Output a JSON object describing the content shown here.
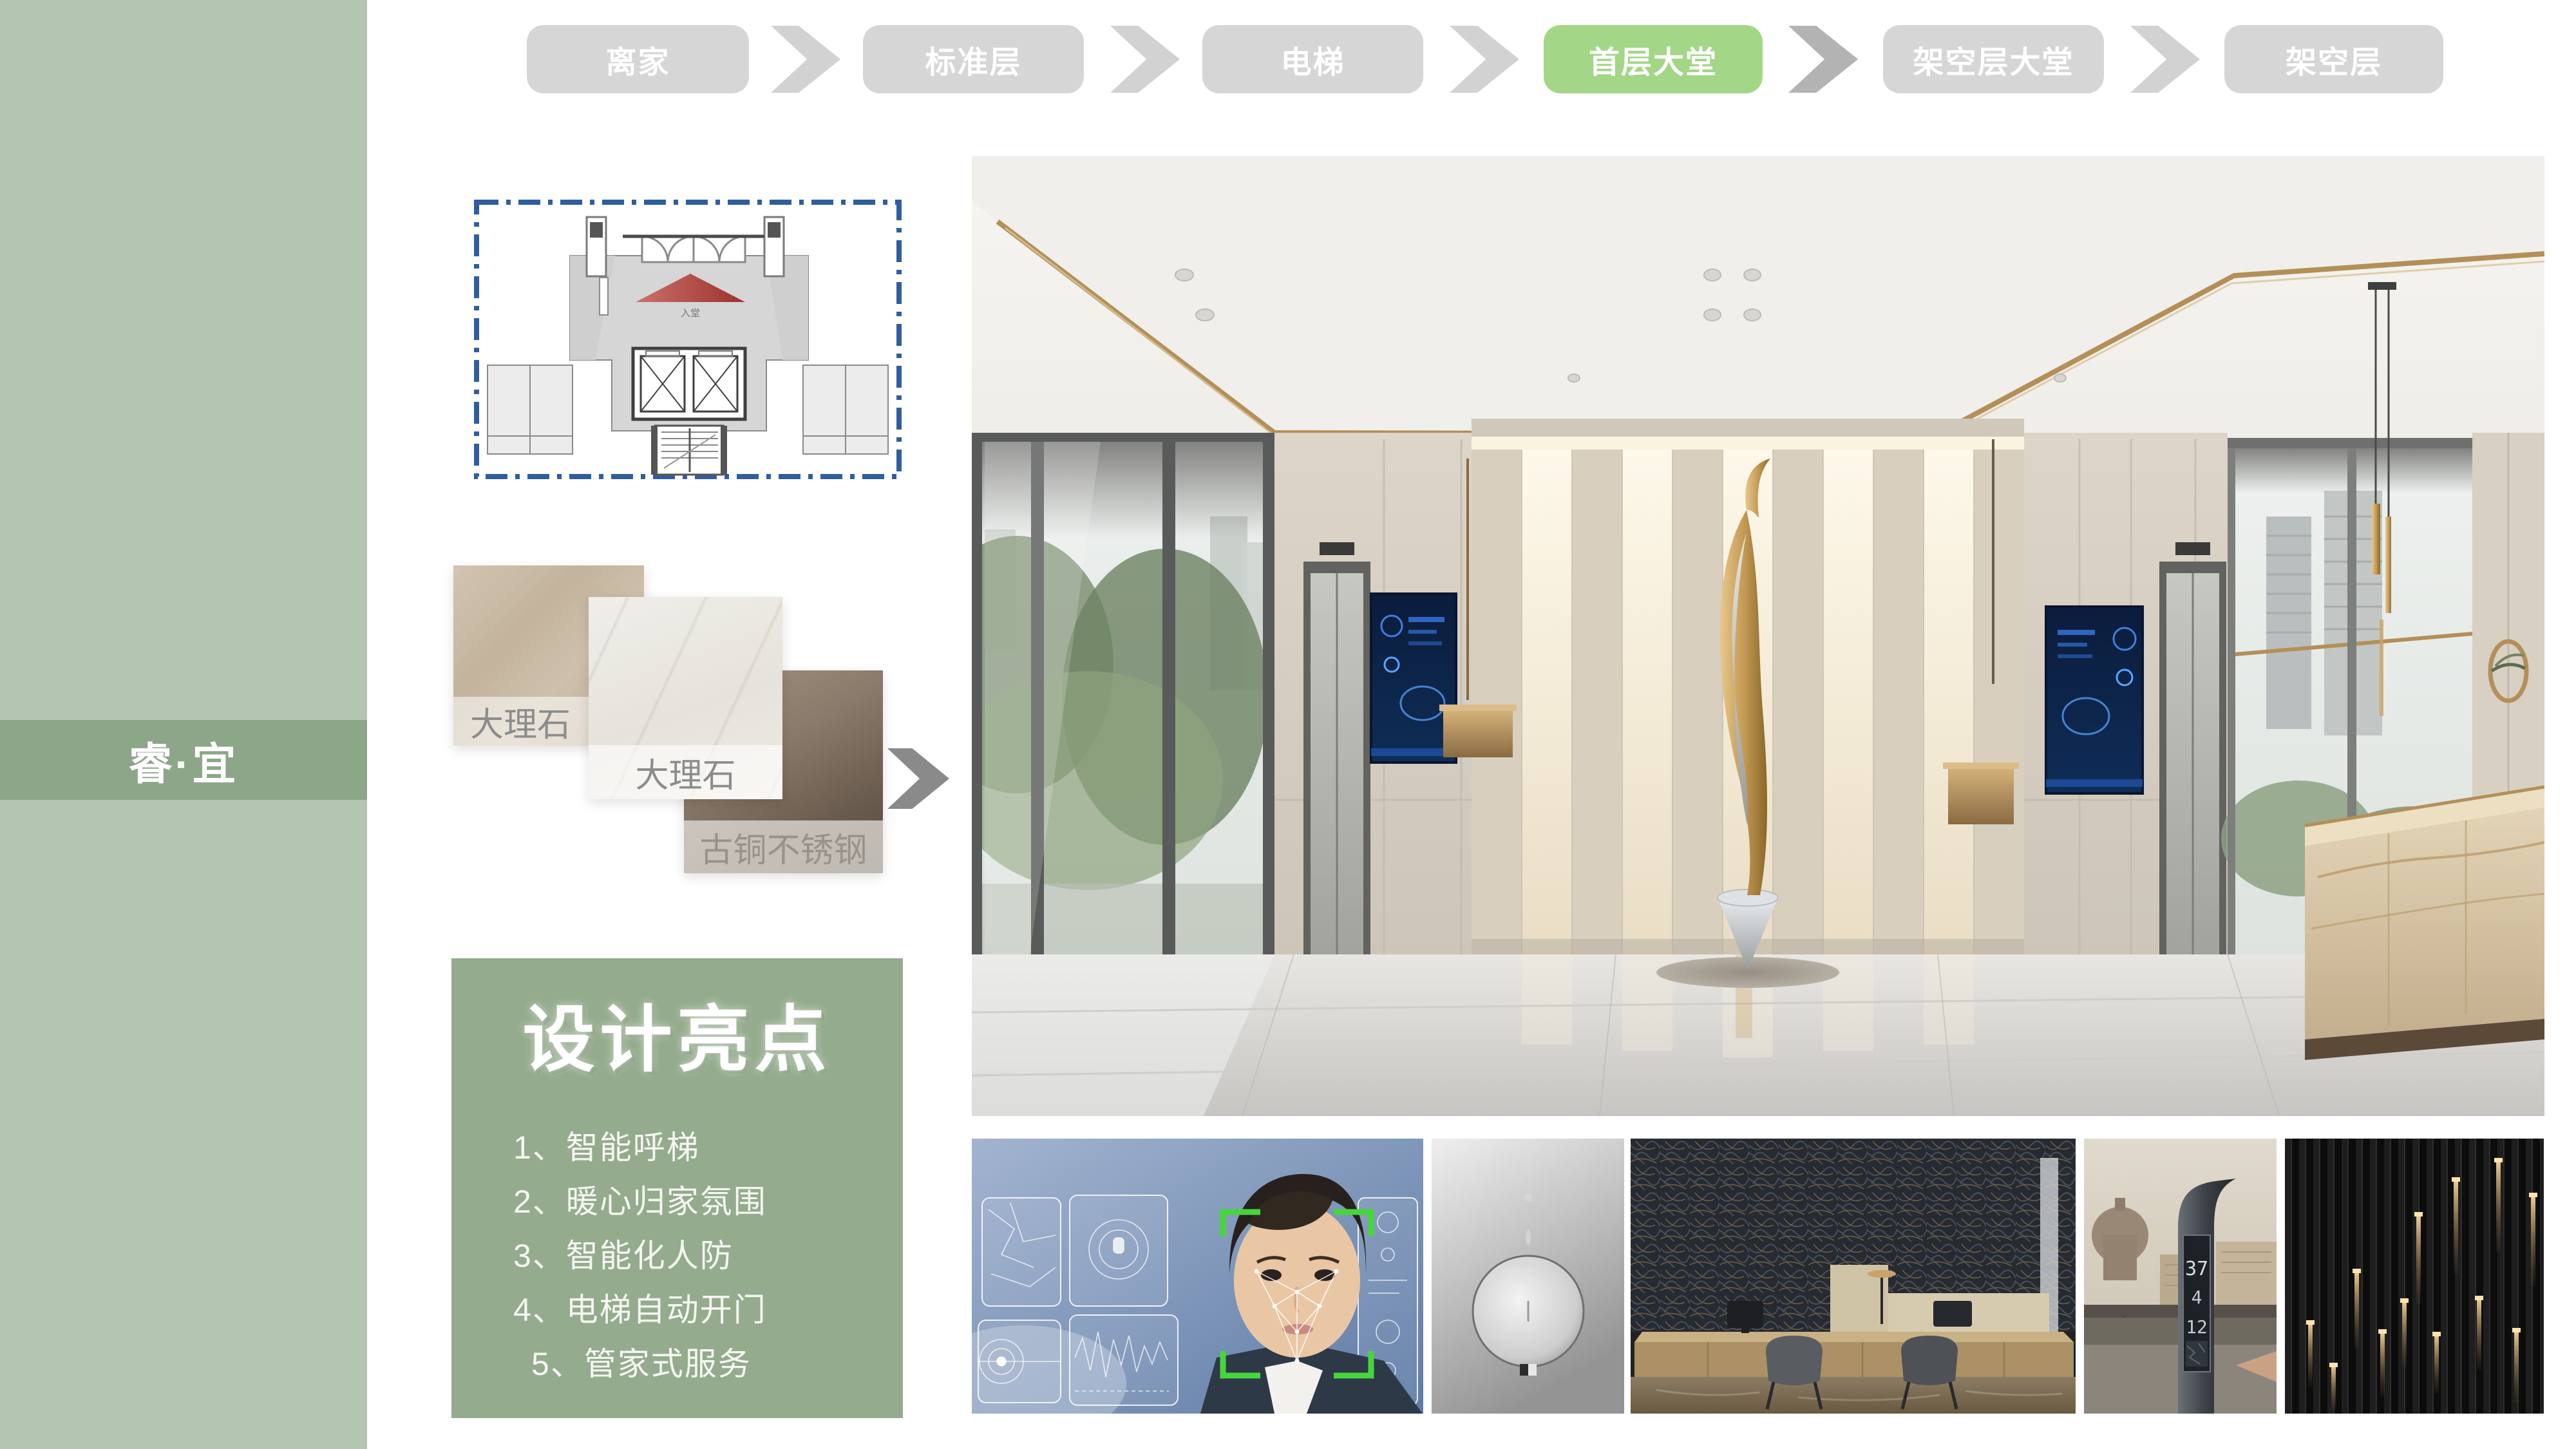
{
  "sidebar": {
    "brand": "睿·宜"
  },
  "nav": {
    "items": [
      {
        "label": "离家",
        "active": false
      },
      {
        "label": "标准层",
        "active": false
      },
      {
        "label": "电梯",
        "active": false
      },
      {
        "label": "首层大堂",
        "active": true
      },
      {
        "label": "架空层大堂",
        "active": false
      },
      {
        "label": "架空层",
        "active": false
      }
    ]
  },
  "floor_plan": {
    "entrance_label": "入堂"
  },
  "materials": {
    "swatches": [
      {
        "label": "大理石"
      },
      {
        "label": "大理石"
      },
      {
        "label": "古铜不锈钢"
      }
    ]
  },
  "highlights": {
    "title": "设计亮点",
    "items": [
      "1、智能呼梯",
      "2、暖心归家氛围",
      "3、智能化人防",
      "4、电梯自动开门",
      "5、管家式服务"
    ]
  },
  "thumbnails": [
    {
      "name": "face-recognition"
    },
    {
      "name": "metal-dial"
    },
    {
      "name": "reception-desk"
    },
    {
      "name": "smart-info-pole",
      "display_digits": [
        "37",
        "4",
        "12"
      ]
    },
    {
      "name": "slat-wall-lights"
    }
  ],
  "colors": {
    "active_green": "#a3d687",
    "nav_gray": "#d6d6d6",
    "sidebar_green": "#b4c5b0",
    "sidebar_band_green": "#8da689",
    "panel_green": "#94ab8d",
    "plan_border_blue": "#2f5e9e",
    "entry_arrow_red": "#b23b33",
    "brass": "#b48f58"
  }
}
